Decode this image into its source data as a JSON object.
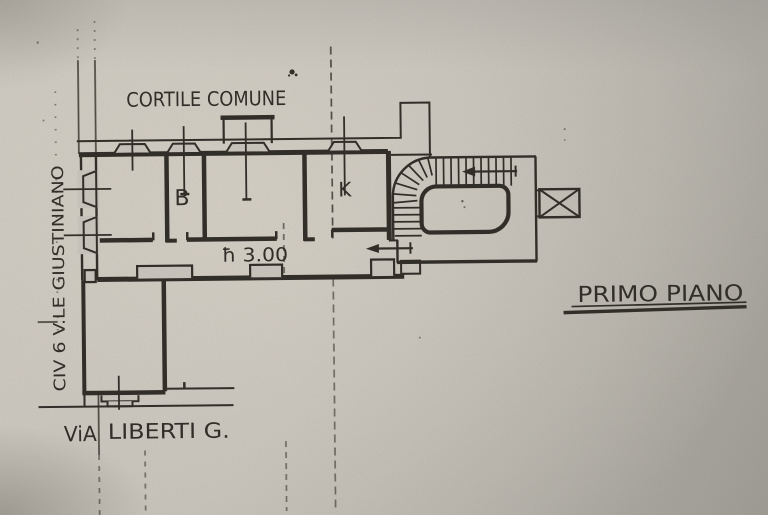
{
  "page": {
    "paper_color": "#d2cec5",
    "ink_color": "#35322c",
    "labels": {
      "courtyard": "CORTILE COMUNE",
      "room_b": "B",
      "room_k": "K",
      "ceiling_height": "ħ 3.00",
      "floor_title": "PRIMO PIANO",
      "street_bottom_word1": "ViA",
      "street_bottom_rest": "LIBERTI G.",
      "street_left": "CIV 6 V.LE GIUSTINIANO"
    }
  }
}
